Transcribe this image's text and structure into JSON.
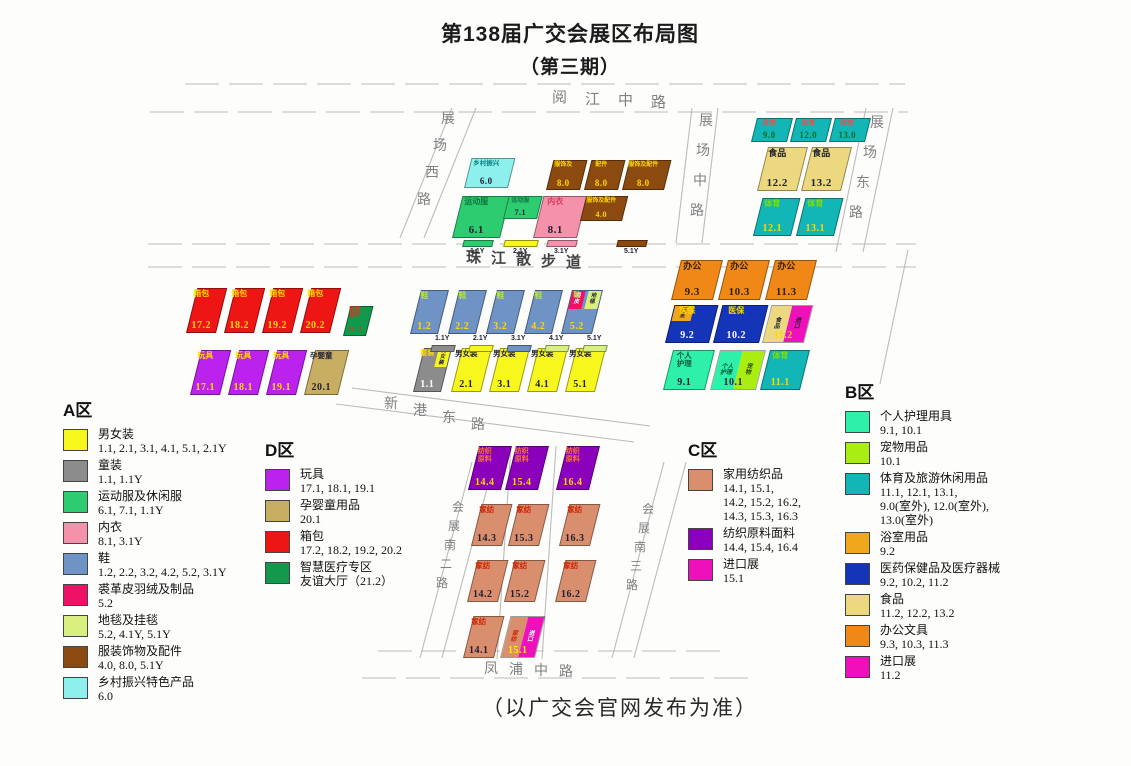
{
  "title": {
    "line1": "第138届广交会展区布局图",
    "line2": "（第三期）"
  },
  "footer": "（以广交会官网发布为准）",
  "roads": [
    {
      "id": "yuejiang",
      "label": "阅江中路"
    },
    {
      "id": "zhanchang-xi",
      "label": "展场西路"
    },
    {
      "id": "zhanchang-zhong",
      "label": "展场中路"
    },
    {
      "id": "zhanchang-dong",
      "label": "展场东路"
    },
    {
      "id": "zhujiang-walk",
      "label": "珠江散步道"
    },
    {
      "id": "xingang-dong",
      "label": "新港东路"
    },
    {
      "id": "huizhan-nan-2",
      "label": "会展南二路"
    },
    {
      "id": "huizhan-nan-3",
      "label": "会展南三路"
    },
    {
      "id": "fengpu",
      "label": "凤浦中路"
    }
  ],
  "halls": [
    {
      "id": "6.0",
      "label": "乡村振兴",
      "num": "6.0",
      "x": 464,
      "y": 158,
      "w": 44,
      "h": 30,
      "bg": "#8df0ec",
      "lc": "#0c8585",
      "nc": "#223",
      "lfs": 6.5,
      "nfs": 9
    },
    {
      "id": "8.0a",
      "label": "服饰及",
      "num": "8.0",
      "x": 546,
      "y": 160,
      "w": 34,
      "h": 30,
      "bg": "#8a4a10",
      "lc": "#ffd700",
      "nc": "#ffd700",
      "lfs": 6,
      "nfs": 9
    },
    {
      "id": "8.0b",
      "label": "配件",
      "num": "8.0",
      "x": 584,
      "y": 160,
      "w": 34,
      "h": 30,
      "bg": "#8a4a10",
      "lc": "#ffd700",
      "nc": "#ffd700",
      "lfs": 6,
      "nfs": 9
    },
    {
      "id": "8.0c",
      "label": "服饰及配件",
      "num": "8.0",
      "x": 622,
      "y": 160,
      "w": 42,
      "h": 30,
      "bg": "#8a4a10",
      "lc": "#ffd700",
      "nc": "#ffd700",
      "lfs": 6,
      "nfs": 9
    },
    {
      "id": "6.1",
      "label": "运动服",
      "num": "6.1",
      "x": 452,
      "y": 196,
      "w": 48,
      "h": 42,
      "bg": "#2dcc70",
      "lc": "#0c7a40",
      "nc": "#223",
      "lfs": 8,
      "nfs": 11
    },
    {
      "id": "7.1",
      "label": "运动服",
      "num": "7.1",
      "x": 503,
      "y": 196,
      "w": 34,
      "h": 23,
      "bg": "#2dcc70",
      "lc": "#0c7a40",
      "nc": "#223",
      "lfs": 6,
      "nfs": 8
    },
    {
      "id": "8.1",
      "label": "内衣",
      "num": "8.1",
      "x": 533,
      "y": 196,
      "w": 44,
      "h": 42,
      "bg": "#f492ac",
      "lc": "#d83a5e",
      "nc": "#223",
      "lfs": 8,
      "nfs": 11
    },
    {
      "id": "4.0",
      "label": "服饰及配件",
      "num": "4.0",
      "x": 580,
      "y": 196,
      "w": 42,
      "h": 25,
      "bg": "#8a4a10",
      "lc": "#ffd700",
      "nc": "#ffd700",
      "lfs": 6,
      "nfs": 8
    },
    {
      "id": "9.0",
      "label": "体育",
      "num": "9.0",
      "x": 751,
      "y": 118,
      "w": 36,
      "h": 24,
      "bg": "#12b6b6",
      "lc": "#e05555",
      "nc": "#0a6a2a",
      "lfs": 7,
      "nfs": 9
    },
    {
      "id": "12.0",
      "label": "体育",
      "num": "12.0",
      "x": 790,
      "y": 118,
      "w": 36,
      "h": 24,
      "bg": "#12b6b6",
      "lc": "#e05555",
      "nc": "#0a6a2a",
      "lfs": 7,
      "nfs": 9
    },
    {
      "id": "13.0",
      "label": "体育",
      "num": "13.0",
      "x": 829,
      "y": 118,
      "w": 36,
      "h": 24,
      "bg": "#12b6b6",
      "lc": "#e05555",
      "nc": "#0a6a2a",
      "lfs": 7,
      "nfs": 9
    },
    {
      "id": "12.2",
      "label": "食品",
      "num": "12.2",
      "x": 757,
      "y": 147,
      "w": 40,
      "h": 44,
      "bg": "#ecd87f",
      "lc": "#223",
      "nc": "#223",
      "lfs": 9,
      "nfs": 11
    },
    {
      "id": "13.2",
      "label": "食品",
      "num": "13.2",
      "x": 801,
      "y": 147,
      "w": 40,
      "h": 44,
      "bg": "#ecd87f",
      "lc": "#223",
      "nc": "#223",
      "lfs": 9,
      "nfs": 11
    },
    {
      "id": "12.1",
      "label": "体育",
      "num": "12.1",
      "x": 753,
      "y": 198,
      "w": 38,
      "h": 38,
      "bg": "#12b6b6",
      "lc": "#7fe000",
      "nc": "#ffd700",
      "lfs": 8,
      "nfs": 10
    },
    {
      "id": "13.1",
      "label": "体育",
      "num": "13.1",
      "x": 796,
      "y": 198,
      "w": 38,
      "h": 38,
      "bg": "#12b6b6",
      "lc": "#7fe000",
      "nc": "#ffd700",
      "lfs": 8,
      "nfs": 10
    },
    {
      "id": "9.3",
      "label": "办公",
      "num": "9.3",
      "x": 671,
      "y": 260,
      "w": 42,
      "h": 40,
      "bg": "#f08818",
      "lc": "#332200",
      "nc": "#332200",
      "lfs": 9,
      "nfs": 11
    },
    {
      "id": "10.3",
      "label": "办公",
      "num": "10.3",
      "x": 718,
      "y": 260,
      "w": 42,
      "h": 40,
      "bg": "#f08818",
      "lc": "#332200",
      "nc": "#332200",
      "lfs": 9,
      "nfs": 11
    },
    {
      "id": "11.3",
      "label": "办公",
      "num": "11.3",
      "x": 765,
      "y": 260,
      "w": 42,
      "h": 40,
      "bg": "#f08818",
      "lc": "#332200",
      "nc": "#332200",
      "lfs": 9,
      "nfs": 11
    },
    {
      "id": "9.2",
      "label": "医保",
      "num": "9.2",
      "x": 665,
      "y": 305,
      "w": 44,
      "h": 38,
      "bg": "#1535b8",
      "lc": "#ffd700",
      "nc": "#ffffff",
      "lfs": 8,
      "nfs": 10,
      "wedges": [
        {
          "t": "浴室",
          "bg": "#f0a81a",
          "tc": "#223",
          "pos": "tl",
          "v": true
        }
      ]
    },
    {
      "id": "10.2",
      "label": "医保",
      "num": "10.2",
      "x": 713,
      "y": 305,
      "w": 46,
      "h": 38,
      "bg": "#1535b8",
      "lc": "#ffd700",
      "nc": "#ffffff",
      "lfs": 8,
      "nfs": 10
    },
    {
      "id": "11.2",
      "num": "11.2",
      "x": 762,
      "y": 305,
      "w": 42,
      "h": 38,
      "nc": "#ffd700",
      "nfs": 10,
      "split": [
        {
          "t": "食品",
          "bg": "#ecd87f",
          "tc": "#223",
          "v": true
        },
        {
          "t": "进口",
          "bg": "#ee11bb",
          "tc": "#223",
          "v": true
        }
      ]
    },
    {
      "id": "9.1",
      "label": "个人\n护理",
      "num": "9.1",
      "x": 663,
      "y": 350,
      "w": 42,
      "h": 40,
      "bg": "#2ef0a8",
      "lc": "#0a5a3a",
      "nc": "#223",
      "lfs": 7.5,
      "nfs": 10
    },
    {
      "id": "10.1",
      "num": "10.1",
      "x": 710,
      "y": 350,
      "w": 46,
      "h": 40,
      "nc": "#223",
      "nfs": 10,
      "split": [
        {
          "t": "个人\n护理",
          "bg": "#2ef0a8",
          "tc": "#0a5a3a"
        },
        {
          "t": "宠物",
          "bg": "#aaee11",
          "tc": "#304a00",
          "v": true
        }
      ]
    },
    {
      "id": "11.1",
      "label": "体育",
      "num": "11.1",
      "x": 760,
      "y": 350,
      "w": 40,
      "h": 40,
      "bg": "#12b6b6",
      "lc": "#7fe000",
      "nc": "#ffd700",
      "lfs": 8,
      "nfs": 10
    },
    {
      "id": "17.2",
      "label": "箱包",
      "num": "17.2",
      "x": 186,
      "y": 288,
      "w": 30,
      "h": 45,
      "bg": "#ee1515",
      "lc": "#ffd700",
      "nc": "#ffd700",
      "lfs": 8,
      "nfs": 10
    },
    {
      "id": "18.2",
      "label": "箱包",
      "num": "18.2",
      "x": 224,
      "y": 288,
      "w": 30,
      "h": 45,
      "bg": "#ee1515",
      "lc": "#ffd700",
      "nc": "#ffd700",
      "lfs": 8,
      "nfs": 10
    },
    {
      "id": "19.2",
      "label": "箱包",
      "num": "19.2",
      "x": 262,
      "y": 288,
      "w": 30,
      "h": 45,
      "bg": "#ee1515",
      "lc": "#ffd700",
      "nc": "#ffd700",
      "lfs": 8,
      "nfs": 10
    },
    {
      "id": "20.2",
      "label": "箱包",
      "num": "20.2",
      "x": 300,
      "y": 288,
      "w": 30,
      "h": 45,
      "bg": "#ee1515",
      "lc": "#ffd700",
      "nc": "#ffd700",
      "lfs": 8,
      "nfs": 10
    },
    {
      "id": "21.2",
      "label": "智慧\n医疗",
      "num": "21.2",
      "x": 343,
      "y": 306,
      "w": 23,
      "h": 30,
      "bg": "#12994e",
      "lc": "#e03020",
      "nc": "#e03020",
      "lfs": 5.5,
      "nfs": 7
    },
    {
      "id": "17.1",
      "label": "玩具",
      "num": "17.1",
      "x": 190,
      "y": 350,
      "w": 30,
      "h": 45,
      "bg": "#bb22ee",
      "lc": "#ffd700",
      "nc": "#ffd700",
      "lfs": 8,
      "nfs": 10
    },
    {
      "id": "18.1",
      "label": "玩具",
      "num": "18.1",
      "x": 228,
      "y": 350,
      "w": 30,
      "h": 45,
      "bg": "#bb22ee",
      "lc": "#ffd700",
      "nc": "#ffd700",
      "lfs": 8,
      "nfs": 10
    },
    {
      "id": "19.1",
      "label": "玩具",
      "num": "19.1",
      "x": 266,
      "y": 350,
      "w": 30,
      "h": 45,
      "bg": "#bb22ee",
      "lc": "#ffd700",
      "nc": "#ffd700",
      "lfs": 8,
      "nfs": 10
    },
    {
      "id": "20.1",
      "label": "孕婴童",
      "num": "20.1",
      "x": 304,
      "y": 350,
      "w": 34,
      "h": 45,
      "bg": "#c8ae62",
      "lc": "#223",
      "nc": "#223",
      "lfs": 7.5,
      "nfs": 10
    },
    {
      "id": "1.2",
      "label": "鞋",
      "num": "1.2",
      "x": 410,
      "y": 290,
      "w": 28,
      "h": 44,
      "bg": "#6f93c4",
      "lc": "#b8e048",
      "nc": "#ffd700",
      "lfs": 8,
      "nfs": 10
    },
    {
      "id": "2.2",
      "label": "鞋",
      "num": "2.2",
      "x": 448,
      "y": 290,
      "w": 28,
      "h": 44,
      "bg": "#6f93c4",
      "lc": "#b8e048",
      "nc": "#ffd700",
      "lfs": 8,
      "nfs": 10
    },
    {
      "id": "3.2",
      "label": "鞋",
      "num": "3.2",
      "x": 486,
      "y": 290,
      "w": 28,
      "h": 44,
      "bg": "#6f93c4",
      "lc": "#b8e048",
      "nc": "#ffd700",
      "lfs": 8,
      "nfs": 10
    },
    {
      "id": "4.2",
      "label": "鞋",
      "num": "4.2",
      "x": 524,
      "y": 290,
      "w": 28,
      "h": 44,
      "bg": "#6f93c4",
      "lc": "#b8e048",
      "nc": "#ffd700",
      "lfs": 8,
      "nfs": 10
    },
    {
      "id": "5.2",
      "label": "鞋",
      "num": "5.2",
      "x": 561,
      "y": 290,
      "w": 31,
      "h": 44,
      "bg": "#6f93c4",
      "lc": "#b8e048",
      "nc": "#ffd700",
      "lfs": 7,
      "nfs": 10,
      "wedges": [
        {
          "t": "裘皮",
          "bg": "#ee1166",
          "tc": "#fff",
          "pos": "tl",
          "v": true
        },
        {
          "t": "地毯",
          "bg": "#d8f080",
          "tc": "#223",
          "pos": "tr",
          "v": true
        }
      ]
    },
    {
      "id": "1.1",
      "label": "童装",
      "num": "1.1",
      "x": 413,
      "y": 348,
      "w": 28,
      "h": 44,
      "bg": "#8c8c8c",
      "lc": "#ffd700",
      "nc": "#ffffff",
      "lfs": 7,
      "nfs": 10,
      "wedges": [
        {
          "t": "男女装",
          "bg": "#f7f71e",
          "tc": "#223",
          "pos": "tr",
          "v": true
        }
      ]
    },
    {
      "id": "2.1",
      "label": "男女装",
      "num": "2.1",
      "x": 451,
      "y": 348,
      "w": 30,
      "h": 44,
      "bg": "#f7f71e",
      "lc": "#223",
      "nc": "#223",
      "lfs": 7.5,
      "nfs": 10
    },
    {
      "id": "3.1",
      "label": "男女装",
      "num": "3.1",
      "x": 489,
      "y": 348,
      "w": 30,
      "h": 44,
      "bg": "#f7f71e",
      "lc": "#223",
      "nc": "#223",
      "lfs": 7.5,
      "nfs": 10
    },
    {
      "id": "4.1",
      "label": "男女装",
      "num": "4.1",
      "x": 527,
      "y": 348,
      "w": 30,
      "h": 44,
      "bg": "#f7f71e",
      "lc": "#223",
      "nc": "#223",
      "lfs": 7.5,
      "nfs": 10
    },
    {
      "id": "5.1",
      "label": "男女装",
      "num": "5.1",
      "x": 565,
      "y": 348,
      "w": 30,
      "h": 44,
      "bg": "#f7f71e",
      "lc": "#223",
      "nc": "#223",
      "lfs": 7.5,
      "nfs": 10
    },
    {
      "id": "14.4",
      "label": "纺织\n原料",
      "num": "14.4",
      "x": 468,
      "y": 446,
      "w": 33,
      "h": 44,
      "bg": "#8a00bb",
      "lc": "#ff7722",
      "nc": "#ffd700",
      "lfs": 7,
      "nfs": 10
    },
    {
      "id": "15.4",
      "label": "纺织\n原料",
      "num": "15.4",
      "x": 505,
      "y": 446,
      "w": 33,
      "h": 44,
      "bg": "#8a00bb",
      "lc": "#ff7722",
      "nc": "#ffd700",
      "lfs": 7,
      "nfs": 10
    },
    {
      "id": "16.4",
      "label": "纺织\n原料",
      "num": "16.4",
      "x": 556,
      "y": 446,
      "w": 33,
      "h": 44,
      "bg": "#8a00bb",
      "lc": "#ff7722",
      "nc": "#ffd700",
      "lfs": 7,
      "nfs": 10
    },
    {
      "id": "14.3",
      "label": "家纺",
      "num": "14.3",
      "x": 471,
      "y": 504,
      "w": 31,
      "h": 42,
      "bg": "#d98e6e",
      "lc": "#cc2200",
      "nc": "#223",
      "lfs": 7.5,
      "nfs": 10
    },
    {
      "id": "15.3",
      "label": "家纺",
      "num": "15.3",
      "x": 508,
      "y": 504,
      "w": 31,
      "h": 42,
      "bg": "#d98e6e",
      "lc": "#cc2200",
      "nc": "#223",
      "lfs": 7.5,
      "nfs": 10
    },
    {
      "id": "16.3",
      "label": "家纺",
      "num": "16.3",
      "x": 559,
      "y": 504,
      "w": 31,
      "h": 42,
      "bg": "#d98e6e",
      "lc": "#cc2200",
      "nc": "#223",
      "lfs": 7.5,
      "nfs": 10
    },
    {
      "id": "14.2",
      "label": "家纺",
      "num": "14.2",
      "x": 467,
      "y": 560,
      "w": 31,
      "h": 42,
      "bg": "#d98e6e",
      "lc": "#cc2200",
      "nc": "#223",
      "lfs": 7.5,
      "nfs": 10
    },
    {
      "id": "15.2",
      "label": "家纺",
      "num": "15.2",
      "x": 504,
      "y": 560,
      "w": 31,
      "h": 42,
      "bg": "#d98e6e",
      "lc": "#cc2200",
      "nc": "#223",
      "lfs": 7.5,
      "nfs": 10
    },
    {
      "id": "16.2",
      "label": "家纺",
      "num": "16.2",
      "x": 555,
      "y": 560,
      "w": 31,
      "h": 42,
      "bg": "#d98e6e",
      "lc": "#cc2200",
      "nc": "#223",
      "lfs": 7.5,
      "nfs": 10
    },
    {
      "id": "14.1",
      "label": "家纺",
      "num": "14.1",
      "x": 463,
      "y": 616,
      "w": 31,
      "h": 42,
      "bg": "#d98e6e",
      "lc": "#cc2200",
      "nc": "#223",
      "lfs": 7.5,
      "nfs": 10
    },
    {
      "id": "15.1",
      "num": "15.1",
      "x": 500,
      "y": 616,
      "w": 35,
      "h": 42,
      "nc": "#ffee00",
      "nfs": 10,
      "split": [
        {
          "t": "家纺",
          "bg": "#d98e6e",
          "tc": "#cc2200",
          "v": true
        },
        {
          "t": "进口",
          "bg": "#ee11bb",
          "tc": "#ffffff",
          "v": true
        }
      ]
    }
  ],
  "strips": [
    {
      "id": "north-1.1Y",
      "label": "1.1Y",
      "x": 463,
      "y": 240,
      "w": 30,
      "color": "#2dcc70",
      "labelPos": "below"
    },
    {
      "id": "north-2.1Y",
      "label": "2.1Y",
      "x": 504,
      "y": 240,
      "w": 34,
      "color": "#f7f71e",
      "labelPos": "below"
    },
    {
      "id": "north-3.1Y",
      "label": "3.1Y",
      "x": 547,
      "y": 240,
      "w": 30,
      "color": "#f492ac",
      "labelPos": "below"
    },
    {
      "id": "north-5.1Y",
      "label": "5.1Y",
      "x": 617,
      "y": 240,
      "w": 30,
      "color": "#8a4a10",
      "labelPos": "below"
    },
    {
      "id": "south-1.1Y",
      "label": "1.1Y",
      "x": 431,
      "y": 345,
      "w": 24,
      "color": "#8c8c8c",
      "labelPos": "above"
    },
    {
      "id": "south-2.1Y",
      "label": "2.1Y",
      "x": 469,
      "y": 345,
      "w": 24,
      "color": "#f7f71e",
      "labelPos": "above"
    },
    {
      "id": "south-3.1Y",
      "label": "3.1Y",
      "x": 507,
      "y": 345,
      "w": 24,
      "color": "#6f93c4",
      "labelPos": "above"
    },
    {
      "id": "south-4.1Y",
      "label": "4.1Y",
      "x": 545,
      "y": 345,
      "w": 24,
      "color": "#d8f080",
      "labelPos": "above"
    },
    {
      "id": "south-5.1Y",
      "label": "5.1Y",
      "x": 583,
      "y": 345,
      "w": 24,
      "color": "#d8f080",
      "labelPos": "above"
    }
  ],
  "legends": [
    {
      "id": "a",
      "title": "A区",
      "items": [
        {
          "label": "男女装",
          "values": [
            "1.1, 2.1, 3.1, 4.1, 5.1, 2.1Y"
          ],
          "color": "#f7f71e"
        },
        {
          "label": "童装",
          "values": [
            "1.1, 1.1Y"
          ],
          "color": "#8c8c8c"
        },
        {
          "label": "运动服及休闲服",
          "values": [
            "6.1, 7.1, 1.1Y"
          ],
          "color": "#2dcc70"
        },
        {
          "label": "内衣",
          "values": [
            "8.1, 3.1Y"
          ],
          "color": "#f492ac"
        },
        {
          "label": "鞋",
          "values": [
            "1.2, 2.2, 3.2, 4.2, 5.2, 3.1Y"
          ],
          "color": "#6f93c4"
        },
        {
          "label": "裘革皮羽绒及制品",
          "values": [
            "5.2"
          ],
          "color": "#ee1166"
        },
        {
          "label": "地毯及挂毯",
          "values": [
            "5.2, 4.1Y, 5.1Y"
          ],
          "color": "#d8f080"
        },
        {
          "label": "服装饰物及配件",
          "values": [
            "4.0,  8.0, 5.1Y"
          ],
          "color": "#8a4a10"
        },
        {
          "label": "乡村振兴特色产品",
          "values": [
            "6.0"
          ],
          "color": "#8df0ec"
        }
      ]
    },
    {
      "id": "d",
      "title": "D区",
      "items": [
        {
          "label": "玩具",
          "values": [
            "17.1, 18.1, 19.1"
          ],
          "color": "#bb22ee"
        },
        {
          "label": "孕婴童用品",
          "values": [
            "20.1"
          ],
          "color": "#c8ae62"
        },
        {
          "label": "箱包",
          "values": [
            "17.2, 18.2, 19.2, 20.2"
          ],
          "color": "#ee1515"
        },
        {
          "label": "智慧医疗专区",
          "values": [
            "友谊大厅（21.2）"
          ],
          "color": "#12994e"
        }
      ]
    },
    {
      "id": "c",
      "title": "C区",
      "items": [
        {
          "label": "家用纺织品",
          "values": [
            "14.1, 15.1,",
            "14.2, 15.2, 16.2,",
            "14.3, 15.3, 16.3"
          ],
          "color": "#d98e6e"
        },
        {
          "label": "纺织原料面料",
          "values": [
            "14.4, 15.4, 16.4"
          ],
          "color": "#8a00bb"
        },
        {
          "label": "进口展",
          "values": [
            "15.1"
          ],
          "color": "#ee11bb"
        }
      ]
    },
    {
      "id": "b",
      "title": "B区",
      "items": [
        {
          "label": "个人护理用具",
          "values": [
            "9.1, 10.1"
          ],
          "color": "#2ef0a8"
        },
        {
          "label": "宠物用品",
          "values": [
            "10.1"
          ],
          "color": "#aaee11"
        },
        {
          "label": "体育及旅游休闲用品",
          "values": [
            "11.1, 12.1, 13.1,",
            "9.0(室外), 12.0(室外),",
            "13.0(室外)"
          ],
          "color": "#12b6b6"
        },
        {
          "label": "浴室用品",
          "values": [
            "9.2"
          ],
          "color": "#f0a81a"
        },
        {
          "label": "医药保健品及医疗器械",
          "values": [
            "9.2, 10.2, 11.2"
          ],
          "color": "#1535b8"
        },
        {
          "label": "食品",
          "values": [
            "11.2, 12.2, 13.2"
          ],
          "color": "#ecd87f"
        },
        {
          "label": "办公文具",
          "values": [
            "9.3, 10.3, 11.3"
          ],
          "color": "#f08818"
        },
        {
          "label": "进口展",
          "values": [
            "11.2"
          ],
          "color": "#ee11bb"
        }
      ]
    }
  ]
}
